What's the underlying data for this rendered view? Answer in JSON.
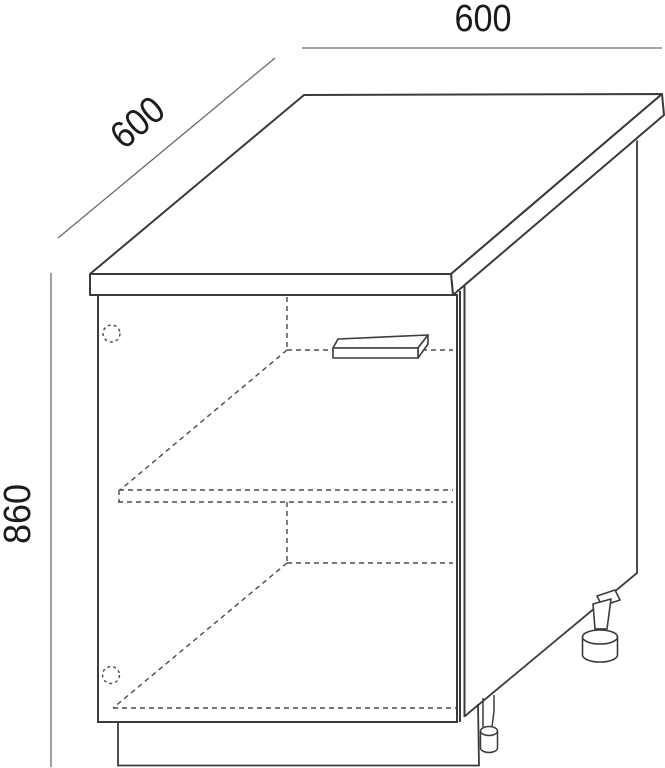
{
  "drawing": {
    "title": "Base cabinet 3D technical line drawing",
    "colors": {
      "background": "#ffffff",
      "solid_line": "#3b3b3b",
      "dashed_line": "#4a4a4a",
      "dimension_line": "#6a6a6a",
      "text": "#1b1b1b"
    },
    "dimensions": [
      {
        "id": "top-width",
        "label": "600",
        "placement": "horizontal line above countertop back edge"
      },
      {
        "id": "depth",
        "label": "600",
        "placement": "diagonal line along upper-left receding edge"
      },
      {
        "id": "height",
        "label": "860",
        "placement": "vertical line along left side"
      }
    ],
    "parts": [
      "countertop-slab",
      "cabinet-front-open",
      "door-gap-double-line",
      "right-side-panel",
      "drawer-handle",
      "hinge-top",
      "hinge-bottom",
      "shelf-hidden-edges",
      "bottom-panel-hidden-edges",
      "plinth-toe-kick",
      "adjustable-foot-front",
      "adjustable-foot-rear"
    ]
  }
}
